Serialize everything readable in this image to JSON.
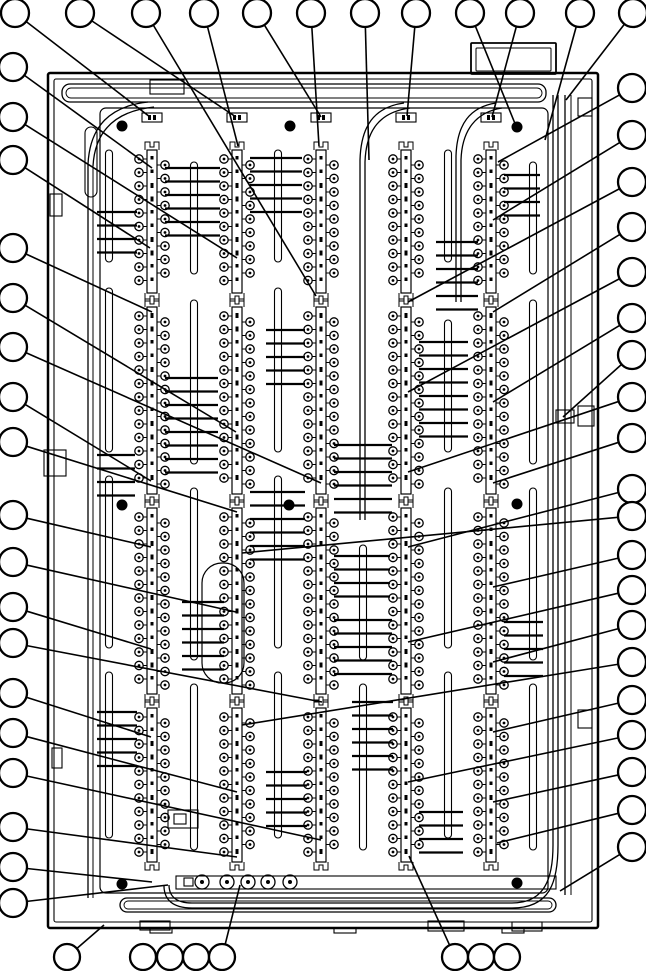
{
  "figure": {
    "type": "technical-assembly-diagram",
    "description": "Exploded-view style callout drawing of an electrical terminal panel with five vertical terminal strips, wiring ducts and empty numbered-balloon callouts",
    "ink": "#000000",
    "background": "#ffffff",
    "width": 646,
    "height": 971,
    "balloon_count": 58,
    "terminal_strip_count": 5
  },
  "balloons": {
    "radius_side": 14,
    "radius_bottom": 13,
    "stroke_width": 2.3,
    "top": [
      [
        15,
        13
      ],
      [
        80,
        13
      ],
      [
        146,
        13
      ],
      [
        204,
        13
      ],
      [
        257,
        13
      ],
      [
        311,
        13
      ],
      [
        365,
        13
      ],
      [
        416,
        13
      ],
      [
        470,
        13
      ],
      [
        520,
        13
      ],
      [
        580,
        13
      ],
      [
        633,
        13
      ]
    ],
    "left": [
      [
        13,
        67
      ],
      [
        13,
        117
      ],
      [
        13,
        160
      ],
      [
        13,
        248
      ],
      [
        13,
        298
      ],
      [
        13,
        347
      ],
      [
        13,
        397
      ],
      [
        13,
        442
      ],
      [
        13,
        515
      ],
      [
        13,
        562
      ],
      [
        13,
        607
      ],
      [
        13,
        643
      ],
      [
        13,
        693
      ],
      [
        13,
        733
      ],
      [
        13,
        773
      ],
      [
        13,
        827
      ],
      [
        13,
        867
      ],
      [
        13,
        903
      ]
    ],
    "right": [
      [
        632,
        88
      ],
      [
        632,
        135
      ],
      [
        632,
        182
      ],
      [
        632,
        227
      ],
      [
        632,
        272
      ],
      [
        632,
        318
      ],
      [
        632,
        355
      ],
      [
        632,
        397
      ],
      [
        632,
        438
      ],
      [
        632,
        489
      ],
      [
        632,
        516
      ],
      [
        632,
        555
      ],
      [
        632,
        590
      ],
      [
        632,
        625
      ],
      [
        632,
        662
      ],
      [
        632,
        700
      ],
      [
        632,
        735
      ],
      [
        632,
        772
      ],
      [
        632,
        810
      ],
      [
        632,
        847
      ]
    ],
    "bottom": [
      [
        67,
        957
      ],
      [
        143,
        957
      ],
      [
        170,
        957
      ],
      [
        196,
        957
      ],
      [
        222,
        957
      ],
      [
        455,
        957
      ],
      [
        481,
        957
      ],
      [
        507,
        957
      ]
    ]
  },
  "leaders": {
    "stroke_width": 1.6,
    "lines": [
      [
        15,
        13,
        150,
        117,
        14
      ],
      [
        80,
        13,
        236,
        117,
        14
      ],
      [
        146,
        13,
        316,
        296,
        14
      ],
      [
        204,
        13,
        238,
        146,
        14
      ],
      [
        257,
        13,
        321,
        117,
        14
      ],
      [
        311,
        13,
        319,
        146,
        14
      ],
      [
        365,
        13,
        369,
        160,
        14
      ],
      [
        416,
        13,
        407,
        116,
        14
      ],
      [
        470,
        13,
        516,
        126,
        14
      ],
      [
        520,
        13,
        492,
        117,
        14
      ],
      [
        580,
        13,
        545,
        140,
        14
      ],
      [
        633,
        13,
        566,
        100,
        14
      ],
      [
        13,
        67,
        152,
        168,
        14
      ],
      [
        13,
        117,
        237,
        258,
        14
      ],
      [
        13,
        160,
        150,
        248,
        14
      ],
      [
        13,
        248,
        152,
        312,
        14
      ],
      [
        13,
        298,
        236,
        432,
        14
      ],
      [
        13,
        347,
        321,
        483,
        14
      ],
      [
        13,
        397,
        151,
        481,
        14
      ],
      [
        13,
        442,
        237,
        512,
        14
      ],
      [
        13,
        515,
        151,
        547,
        14
      ],
      [
        13,
        562,
        236,
        612,
        14
      ],
      [
        13,
        607,
        151,
        649,
        14
      ],
      [
        13,
        643,
        322,
        702,
        14
      ],
      [
        13,
        693,
        151,
        737,
        14
      ],
      [
        13,
        733,
        237,
        792,
        14
      ],
      [
        13,
        773,
        321,
        840,
        14
      ],
      [
        13,
        827,
        237,
        857,
        14
      ],
      [
        13,
        867,
        152,
        882,
        14
      ],
      [
        13,
        903,
        168,
        885,
        14
      ],
      [
        632,
        88,
        498,
        162,
        14
      ],
      [
        632,
        135,
        493,
        220,
        14
      ],
      [
        632,
        182,
        408,
        302,
        14
      ],
      [
        632,
        227,
        493,
        312,
        14
      ],
      [
        632,
        272,
        408,
        392,
        14
      ],
      [
        632,
        318,
        493,
        402,
        14
      ],
      [
        632,
        355,
        563,
        417,
        14
      ],
      [
        632,
        397,
        408,
        472,
        14
      ],
      [
        632,
        438,
        493,
        483,
        14
      ],
      [
        632,
        489,
        408,
        547,
        14
      ],
      [
        632,
        516,
        242,
        553,
        14
      ],
      [
        632,
        555,
        493,
        587,
        14
      ],
      [
        632,
        590,
        408,
        642,
        14
      ],
      [
        632,
        625,
        493,
        662,
        14
      ],
      [
        632,
        662,
        242,
        725,
        14
      ],
      [
        632,
        700,
        493,
        732,
        14
      ],
      [
        632,
        735,
        408,
        782,
        14
      ],
      [
        632,
        772,
        493,
        802,
        14
      ],
      [
        632,
        810,
        497,
        843,
        14
      ],
      [
        632,
        847,
        560,
        891,
        14
      ],
      [
        67,
        957,
        104,
        925,
        13
      ],
      [
        222,
        957,
        240,
        885,
        13
      ],
      [
        455,
        957,
        409,
        856,
        13
      ]
    ]
  },
  "panel": {
    "frame_rects": [
      {
        "x": 48,
        "y": 73,
        "w": 550,
        "h": 855,
        "rx": 2,
        "sw": 2.5
      },
      {
        "x": 54,
        "y": 79,
        "w": 538,
        "h": 843,
        "rx": 2,
        "sw": 1.1
      },
      {
        "x": 471,
        "y": 43,
        "w": 85,
        "h": 31,
        "rx": 1,
        "sw": 1.8
      },
      {
        "x": 476,
        "y": 48,
        "w": 75,
        "h": 23,
        "rx": 1,
        "sw": 1.0
      },
      {
        "x": 100,
        "y": 108,
        "w": 448,
        "h": 785,
        "rx": 6,
        "sw": 1.2
      },
      {
        "x": 62,
        "y": 84,
        "w": 484,
        "h": 18,
        "rx": 8,
        "sw": 1.3
      },
      {
        "x": 66,
        "y": 88,
        "w": 476,
        "h": 10,
        "rx": 5,
        "sw": 0.9
      },
      {
        "x": 120,
        "y": 898,
        "w": 436,
        "h": 14,
        "rx": 7,
        "sw": 1.3
      },
      {
        "x": 124,
        "y": 901,
        "w": 428,
        "h": 8,
        "rx": 4,
        "sw": 0.9
      },
      {
        "x": 85,
        "y": 127,
        "w": 12,
        "h": 70,
        "rx": 6,
        "sw": 1.1
      },
      {
        "x": 202,
        "y": 563,
        "w": 42,
        "h": 120,
        "rx": 20,
        "sw": 1.2
      }
    ],
    "frame_lines": [
      [
        88,
        164,
        88,
        898,
        1.3
      ],
      [
        93,
        166,
        93,
        898,
        1.0
      ],
      [
        565,
        95,
        565,
        895,
        1.3
      ],
      [
        571,
        95,
        571,
        895,
        1.0
      ]
    ],
    "wire_paths": [
      "M 148 102 C 110 106 90 126 88 164",
      "M 154 107 C 116 111 95 130 93 166",
      "M 404 103 C 374 107 361 126 360 160 L 360 520",
      "M 410 108 C 380 112 366 130 365 162 L 365 520",
      "M 496 103 C 470 107 457 124 456 156 L 456 302",
      "M 502 108 C 476 112 462 130 461 160 L 461 302",
      "M 553 95 L 553 845 C 553 878 545 903 512 903 L 192 903",
      "M 558 95 L 558 845 C 558 884 549 908 512 908 L 192 908",
      "M 192 903 C 176 903 169 896 169 885",
      "M 192 908 C 172 908 164 899 164 886"
    ],
    "hardware_rects": [
      [
        578,
        98,
        14,
        18
      ],
      [
        556,
        410,
        18,
        13
      ],
      [
        578,
        406,
        16,
        20
      ],
      [
        578,
        710,
        14,
        18
      ],
      [
        44,
        450,
        22,
        26
      ],
      [
        50,
        194,
        12,
        22
      ],
      [
        52,
        748,
        10,
        20
      ],
      [
        168,
        810,
        30,
        18
      ],
      [
        174,
        814,
        12,
        10
      ],
      [
        150,
        80,
        34,
        14
      ],
      [
        184,
        878,
        9,
        8
      ],
      [
        140,
        921,
        30,
        9
      ],
      [
        428,
        921,
        36,
        10
      ],
      [
        512,
        922,
        30,
        9
      ],
      [
        150,
        928,
        22,
        5
      ],
      [
        334,
        928,
        22,
        5
      ],
      [
        502,
        928,
        22,
        5
      ]
    ],
    "mounting_holes": {
      "r": 5.5,
      "points": [
        [
          122,
          126
        ],
        [
          290,
          126
        ],
        [
          517,
          127
        ],
        [
          122,
          505
        ],
        [
          289,
          505
        ],
        [
          517,
          504
        ],
        [
          122,
          884
        ],
        [
          517,
          883
        ]
      ]
    }
  },
  "strips": {
    "centers": [
      152,
      237,
      321,
      406,
      491
    ],
    "segments": [
      [
        150,
        293
      ],
      [
        307,
        494
      ],
      [
        508,
        694
      ],
      [
        708,
        862
      ]
    ],
    "pitch": 13.5,
    "terminal_radius": 4.2,
    "terminal_offset": 13,
    "rail_half_width": 5,
    "block_y": 113
  },
  "slots": {
    "width": 7,
    "columns": [
      {
        "x": 109,
        "segs": [
          [
            150,
            262
          ],
          [
            288,
            452
          ],
          [
            476,
            648
          ],
          [
            672,
            838
          ]
        ]
      },
      {
        "x": 194,
        "segs": [
          [
            162,
            274
          ],
          [
            300,
            464
          ],
          [
            488,
            660
          ],
          [
            684,
            850
          ]
        ]
      },
      {
        "x": 278,
        "segs": [
          [
            150,
            262
          ],
          [
            288,
            452
          ],
          [
            476,
            648
          ],
          [
            672,
            838
          ]
        ]
      },
      {
        "x": 363,
        "segs": [
          [
            545,
            660
          ],
          [
            684,
            850
          ]
        ]
      },
      {
        "x": 448,
        "segs": [
          [
            150,
            262
          ],
          [
            320,
            452
          ],
          [
            488,
            648
          ],
          [
            672,
            838
          ]
        ]
      },
      {
        "x": 533,
        "segs": [
          [
            162,
            274
          ],
          [
            300,
            464
          ],
          [
            488,
            660
          ],
          [
            684,
            850
          ]
        ]
      }
    ]
  },
  "wire_groups": {
    "stroke_width": 2.2,
    "pitch": 13.5,
    "groups": [
      [
        165,
        220,
        168,
        6
      ],
      [
        250,
        302,
        158,
        5
      ],
      [
        334,
        392,
        445,
        6
      ],
      [
        165,
        218,
        378,
        8
      ],
      [
        182,
        224,
        602,
        6
      ],
      [
        419,
        468,
        342,
        8
      ],
      [
        352,
        393,
        702,
        6
      ],
      [
        436,
        478,
        242,
        6
      ],
      [
        266,
        307,
        772,
        5
      ],
      [
        504,
        543,
        622,
        5
      ],
      [
        250,
        305,
        492,
        6
      ],
      [
        419,
        463,
        812,
        4
      ],
      [
        334,
        390,
        556,
        4
      ],
      [
        97,
        137,
        712,
        5
      ],
      [
        504,
        540,
        175,
        4
      ],
      [
        266,
        305,
        330,
        5
      ],
      [
        97,
        137,
        212,
        4
      ],
      [
        97,
        135,
        455,
        4
      ],
      [
        334,
        392,
        620,
        5
      ]
    ]
  },
  "bottom_rail": {
    "rect": [
      176,
      876,
      380,
      13
    ],
    "grommet_cy": 882,
    "grommet_r": 7,
    "grommet_xs": [
      202,
      227,
      248,
      268,
      290
    ]
  }
}
